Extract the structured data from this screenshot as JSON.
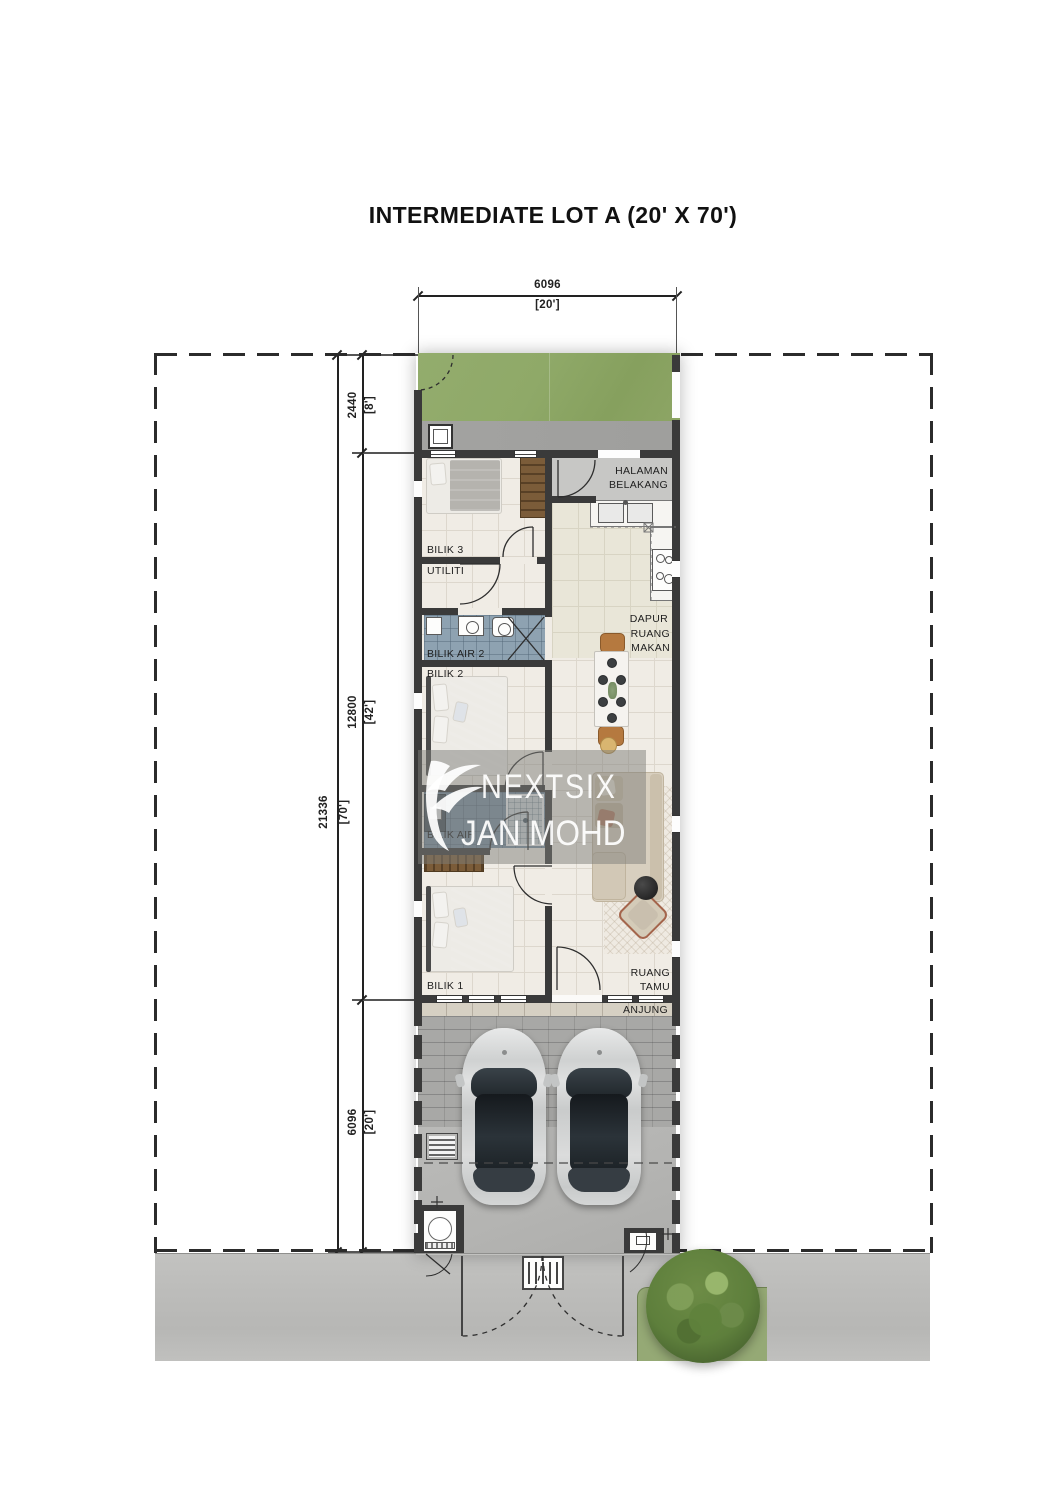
{
  "title": "INTERMEDIATE LOT A (20' X 70')",
  "watermark": {
    "brand": "NEXTSIX",
    "agent": "JAN MOHD"
  },
  "dimensions": {
    "width": {
      "mm": "6096",
      "ft": "[20']"
    },
    "depth_total": {
      "mm": "21336",
      "ft": "[70']"
    },
    "rear_yard": {
      "mm": "2440",
      "ft": "[8']"
    },
    "house": {
      "mm": "12800",
      "ft": "[42']"
    },
    "front_yard": {
      "mm": "6096",
      "ft": "[20']"
    }
  },
  "rooms": {
    "halaman_belakang": {
      "label": "HALAMAN BELAKANG"
    },
    "bilik_3": {
      "label": "BILIK 3"
    },
    "utiliti": {
      "label": "UTILITI"
    },
    "dapur": {
      "label": "DAPUR"
    },
    "ruang_makan": {
      "label": "RUANG MAKAN"
    },
    "bilik_air_2": {
      "label": "BILIK AIR 2"
    },
    "bilik_2": {
      "label": "BILIK 2"
    },
    "bilik_air": {
      "label": "BILIK AIR"
    },
    "bilik_1": {
      "label": "BILIK 1"
    },
    "ruang_tamu": {
      "label": "RUANG TAMU"
    },
    "anjung": {
      "label": "ANJUNG"
    }
  },
  "colors": {
    "line": "#222222",
    "dash": "#2b2b2b",
    "wall": "#3a3a3a",
    "grass": "#8fa968",
    "concrete": "#a0a09e",
    "tile": "#f0ece5",
    "grout": "#ddd7cd",
    "kitchen_tile": "#e9e6d8",
    "kitchen_grout": "#d8d4c3",
    "patio": "#c7c7c5",
    "bath": "#8ea2b1",
    "bath_dark": "#7b90a2",
    "navy": "#32435c",
    "wood": "#7b5c39",
    "sofa": "#d8cfbf",
    "rug": "#efeae2",
    "dining_wood": "#b5793f",
    "chair_gray": "#8c9194",
    "anjung": "#d6d0c3",
    "brick": "#a8a8a6",
    "driveway": "#b4b4b2",
    "road": "#bdbdbb",
    "car_body": "#d6d8d8",
    "car_glass": "#23292e",
    "tree": "#5e7f3c",
    "tree_patch": "#95a975",
    "watermark_band": "rgba(125,125,122,0.5)",
    "watermark_text": "rgba(255,255,255,0.93)"
  }
}
